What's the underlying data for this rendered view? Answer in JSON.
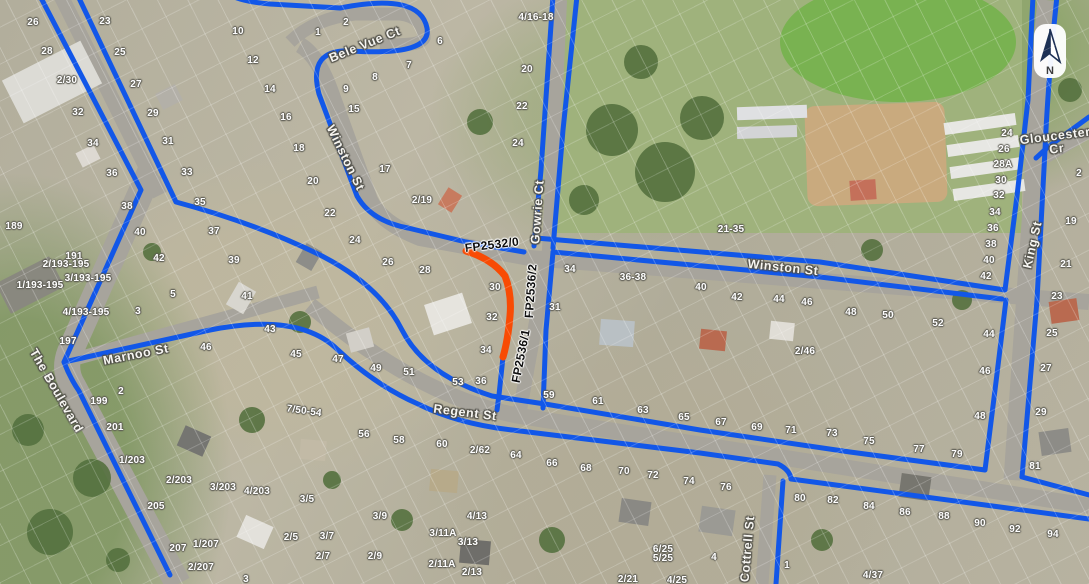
{
  "colors": {
    "path_blue": "#1257e8",
    "highlight_orange": "#f84b04",
    "road_gray": "#a7a49c",
    "park_green": "#9fb27c"
  },
  "north": {
    "label": "N"
  },
  "street_labels": [
    {
      "text": "Bele Vue Ct",
      "x": 365,
      "y": 45,
      "rot": -22
    },
    {
      "text": "Winston St",
      "x": 345,
      "y": 158,
      "rot": 64
    },
    {
      "text": "Winston St",
      "x": 783,
      "y": 268,
      "rot": 6
    },
    {
      "text": "Marnoo St",
      "x": 136,
      "y": 355,
      "rot": -11
    },
    {
      "text": "Regent St",
      "x": 465,
      "y": 413,
      "rot": 7
    },
    {
      "text": "The Boulevard",
      "x": 56,
      "y": 391,
      "rot": 60
    },
    {
      "text": "Gowrie Ct",
      "x": 538,
      "y": 212,
      "rot": -86
    },
    {
      "text": "Cottrell St",
      "x": 748,
      "y": 549,
      "rot": -85
    },
    {
      "text": "King St",
      "x": 1033,
      "y": 245,
      "rot": -77
    },
    {
      "text": "Gloucester\nCr",
      "x": 1056,
      "y": 143,
      "rot": -7
    }
  ],
  "fp_labels": [
    {
      "text": "FP2532/0",
      "x": 492,
      "y": 245,
      "rot": -7
    },
    {
      "text": "FP2536/2",
      "x": 531,
      "y": 291,
      "rot": -86
    },
    {
      "text": "FP2536/1",
      "x": 521,
      "y": 356,
      "rot": -79
    }
  ],
  "house_numbers": [
    {
      "text": "26",
      "x": 33,
      "y": 23
    },
    {
      "text": "23",
      "x": 105,
      "y": 22
    },
    {
      "text": "28",
      "x": 47,
      "y": 52
    },
    {
      "text": "25",
      "x": 120,
      "y": 53
    },
    {
      "text": "2/30",
      "x": 67,
      "y": 81
    },
    {
      "text": "27",
      "x": 136,
      "y": 85
    },
    {
      "text": "32",
      "x": 78,
      "y": 113
    },
    {
      "text": "29",
      "x": 153,
      "y": 114
    },
    {
      "text": "34",
      "x": 93,
      "y": 144
    },
    {
      "text": "31",
      "x": 168,
      "y": 142
    },
    {
      "text": "36",
      "x": 112,
      "y": 174
    },
    {
      "text": "33",
      "x": 187,
      "y": 173
    },
    {
      "text": "189",
      "x": 14,
      "y": 227
    },
    {
      "text": "191",
      "x": 74,
      "y": 257
    },
    {
      "text": "38",
      "x": 127,
      "y": 207
    },
    {
      "text": "40",
      "x": 140,
      "y": 233
    },
    {
      "text": "42",
      "x": 159,
      "y": 259
    },
    {
      "text": "35",
      "x": 200,
      "y": 203
    },
    {
      "text": "37",
      "x": 214,
      "y": 232
    },
    {
      "text": "2/193-195",
      "x": 66,
      "y": 265
    },
    {
      "text": "3/193-195",
      "x": 88,
      "y": 279
    },
    {
      "text": "1/193-195",
      "x": 40,
      "y": 286
    },
    {
      "text": "4/193-195",
      "x": 86,
      "y": 313
    },
    {
      "text": "197",
      "x": 68,
      "y": 342
    },
    {
      "text": "5",
      "x": 173,
      "y": 295
    },
    {
      "text": "3",
      "x": 138,
      "y": 312
    },
    {
      "text": "46",
      "x": 206,
      "y": 348
    },
    {
      "text": "2",
      "x": 121,
      "y": 392
    },
    {
      "text": "199",
      "x": 99,
      "y": 402
    },
    {
      "text": "201",
      "x": 115,
      "y": 428
    },
    {
      "text": "1/203",
      "x": 132,
      "y": 461
    },
    {
      "text": "2/203",
      "x": 179,
      "y": 481
    },
    {
      "text": "3/203",
      "x": 223,
      "y": 488
    },
    {
      "text": "4/203",
      "x": 257,
      "y": 492
    },
    {
      "text": "205",
      "x": 156,
      "y": 507
    },
    {
      "text": "207",
      "x": 178,
      "y": 549
    },
    {
      "text": "1/207",
      "x": 206,
      "y": 545
    },
    {
      "text": "2/207",
      "x": 201,
      "y": 568
    },
    {
      "text": "3/5",
      "x": 307,
      "y": 500
    },
    {
      "text": "2/5",
      "x": 291,
      "y": 538
    },
    {
      "text": "3/7",
      "x": 327,
      "y": 537
    },
    {
      "text": "2/7",
      "x": 323,
      "y": 557
    },
    {
      "text": "3/9",
      "x": 380,
      "y": 517
    },
    {
      "text": "2/9",
      "x": 375,
      "y": 557
    },
    {
      "text": "56",
      "x": 364,
      "y": 435
    },
    {
      "text": "3",
      "x": 246,
      "y": 580
    },
    {
      "text": "10",
      "x": 238,
      "y": 32
    },
    {
      "text": "12",
      "x": 253,
      "y": 61
    },
    {
      "text": "14",
      "x": 270,
      "y": 90
    },
    {
      "text": "16",
      "x": 286,
      "y": 118
    },
    {
      "text": "18",
      "x": 299,
      "y": 149
    },
    {
      "text": "1",
      "x": 318,
      "y": 33
    },
    {
      "text": "2",
      "x": 346,
      "y": 23
    },
    {
      "text": "6",
      "x": 440,
      "y": 42
    },
    {
      "text": "7",
      "x": 409,
      "y": 66
    },
    {
      "text": "8",
      "x": 375,
      "y": 78
    },
    {
      "text": "9",
      "x": 346,
      "y": 90
    },
    {
      "text": "15",
      "x": 354,
      "y": 110
    },
    {
      "text": "17",
      "x": 385,
      "y": 170
    },
    {
      "text": "2/19",
      "x": 422,
      "y": 201
    },
    {
      "text": "20",
      "x": 313,
      "y": 182
    },
    {
      "text": "22",
      "x": 330,
      "y": 214
    },
    {
      "text": "24",
      "x": 355,
      "y": 241
    },
    {
      "text": "26",
      "x": 388,
      "y": 263
    },
    {
      "text": "28",
      "x": 425,
      "y": 271
    },
    {
      "text": "20",
      "x": 527,
      "y": 70
    },
    {
      "text": "22",
      "x": 522,
      "y": 107
    },
    {
      "text": "24",
      "x": 518,
      "y": 144
    },
    {
      "text": "4/16-18",
      "x": 536,
      "y": 18
    },
    {
      "text": "30",
      "x": 495,
      "y": 288
    },
    {
      "text": "32",
      "x": 492,
      "y": 318
    },
    {
      "text": "34",
      "x": 486,
      "y": 351
    },
    {
      "text": "36",
      "x": 481,
      "y": 382
    },
    {
      "text": "53",
      "x": 458,
      "y": 383
    },
    {
      "text": "39",
      "x": 234,
      "y": 261
    },
    {
      "text": "41",
      "x": 247,
      "y": 297
    },
    {
      "text": "43",
      "x": 270,
      "y": 330
    },
    {
      "text": "45",
      "x": 296,
      "y": 355
    },
    {
      "text": "47",
      "x": 338,
      "y": 360
    },
    {
      "text": "49",
      "x": 376,
      "y": 369
    },
    {
      "text": "51",
      "x": 409,
      "y": 373
    },
    {
      "text": "7/50-54",
      "x": 304,
      "y": 412,
      "rot": 8
    },
    {
      "text": "34",
      "x": 570,
      "y": 270
    },
    {
      "text": "31",
      "x": 555,
      "y": 308
    },
    {
      "text": "36-38",
      "x": 633,
      "y": 278
    },
    {
      "text": "40",
      "x": 701,
      "y": 288
    },
    {
      "text": "42",
      "x": 737,
      "y": 298
    },
    {
      "text": "44",
      "x": 779,
      "y": 300
    },
    {
      "text": "46",
      "x": 807,
      "y": 303
    },
    {
      "text": "2/46",
      "x": 805,
      "y": 352
    },
    {
      "text": "21-35",
      "x": 731,
      "y": 230
    },
    {
      "text": "59",
      "x": 549,
      "y": 396
    },
    {
      "text": "61",
      "x": 598,
      "y": 402
    },
    {
      "text": "63",
      "x": 643,
      "y": 411
    },
    {
      "text": "65",
      "x": 684,
      "y": 418
    },
    {
      "text": "67",
      "x": 721,
      "y": 423
    },
    {
      "text": "69",
      "x": 757,
      "y": 428
    },
    {
      "text": "71",
      "x": 791,
      "y": 431
    },
    {
      "text": "73",
      "x": 832,
      "y": 434
    },
    {
      "text": "75",
      "x": 869,
      "y": 442
    },
    {
      "text": "77",
      "x": 919,
      "y": 450
    },
    {
      "text": "79",
      "x": 957,
      "y": 455
    },
    {
      "text": "48",
      "x": 980,
      "y": 417
    },
    {
      "text": "29",
      "x": 1041,
      "y": 413
    },
    {
      "text": "81",
      "x": 1035,
      "y": 467
    },
    {
      "text": "58",
      "x": 399,
      "y": 441
    },
    {
      "text": "60",
      "x": 442,
      "y": 445
    },
    {
      "text": "2/62",
      "x": 480,
      "y": 451
    },
    {
      "text": "64",
      "x": 516,
      "y": 456
    },
    {
      "text": "66",
      "x": 552,
      "y": 464
    },
    {
      "text": "68",
      "x": 586,
      "y": 469
    },
    {
      "text": "4/13",
      "x": 477,
      "y": 517
    },
    {
      "text": "3/11A",
      "x": 443,
      "y": 534
    },
    {
      "text": "3/13",
      "x": 468,
      "y": 543
    },
    {
      "text": "2/11A",
      "x": 442,
      "y": 565
    },
    {
      "text": "2/13",
      "x": 472,
      "y": 573
    },
    {
      "text": "70",
      "x": 624,
      "y": 472
    },
    {
      "text": "72",
      "x": 653,
      "y": 476
    },
    {
      "text": "74",
      "x": 689,
      "y": 482
    },
    {
      "text": "76",
      "x": 726,
      "y": 488
    },
    {
      "text": "80",
      "x": 800,
      "y": 499
    },
    {
      "text": "82",
      "x": 833,
      "y": 501
    },
    {
      "text": "6/25",
      "x": 663,
      "y": 550
    },
    {
      "text": "5/25",
      "x": 663,
      "y": 559
    },
    {
      "text": "4",
      "x": 714,
      "y": 558
    },
    {
      "text": "1",
      "x": 787,
      "y": 566
    },
    {
      "text": "2/21",
      "x": 628,
      "y": 580
    },
    {
      "text": "4/25",
      "x": 677,
      "y": 581
    },
    {
      "text": "84",
      "x": 869,
      "y": 507
    },
    {
      "text": "86",
      "x": 905,
      "y": 513
    },
    {
      "text": "88",
      "x": 944,
      "y": 517
    },
    {
      "text": "90",
      "x": 980,
      "y": 524
    },
    {
      "text": "92",
      "x": 1015,
      "y": 530
    },
    {
      "text": "94",
      "x": 1053,
      "y": 535
    },
    {
      "text": "4/37",
      "x": 873,
      "y": 576
    },
    {
      "text": "24",
      "x": 1007,
      "y": 134
    },
    {
      "text": "26",
      "x": 1004,
      "y": 150
    },
    {
      "text": "28A",
      "x": 1003,
      "y": 165
    },
    {
      "text": "30",
      "x": 1001,
      "y": 181
    },
    {
      "text": "32",
      "x": 999,
      "y": 196
    },
    {
      "text": "34",
      "x": 995,
      "y": 213
    },
    {
      "text": "36",
      "x": 993,
      "y": 229
    },
    {
      "text": "38",
      "x": 991,
      "y": 245
    },
    {
      "text": "40",
      "x": 989,
      "y": 261
    },
    {
      "text": "42",
      "x": 986,
      "y": 277
    },
    {
      "text": "44",
      "x": 989,
      "y": 335
    },
    {
      "text": "46",
      "x": 985,
      "y": 372
    },
    {
      "text": "19",
      "x": 1071,
      "y": 222
    },
    {
      "text": "21",
      "x": 1066,
      "y": 265
    },
    {
      "text": "23",
      "x": 1057,
      "y": 297
    },
    {
      "text": "25",
      "x": 1052,
      "y": 334
    },
    {
      "text": "27",
      "x": 1046,
      "y": 369
    },
    {
      "text": "2",
      "x": 1079,
      "y": 174
    },
    {
      "text": "48",
      "x": 851,
      "y": 313
    },
    {
      "text": "50",
      "x": 888,
      "y": 316
    },
    {
      "text": "52",
      "x": 938,
      "y": 324
    }
  ]
}
